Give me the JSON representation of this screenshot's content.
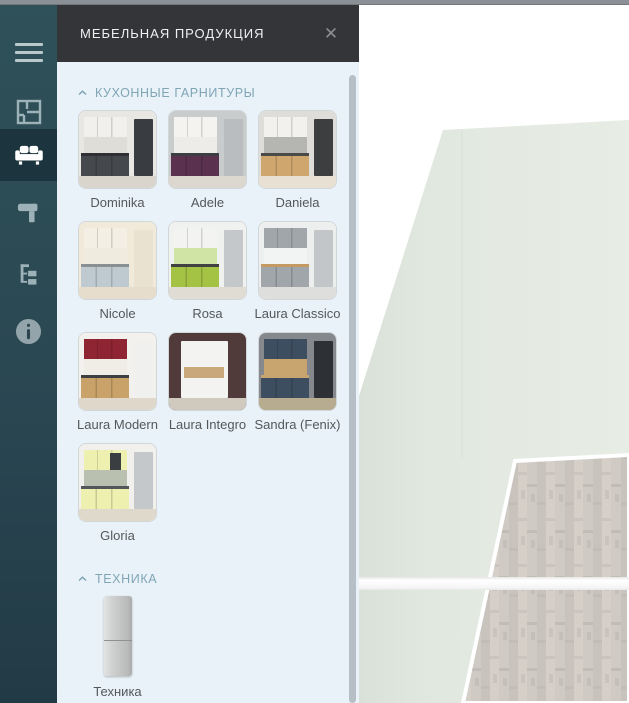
{
  "panel": {
    "title": "МЕБЕЛЬНАЯ ПРОДУКЦИЯ",
    "close_glyph": "✕",
    "sections": [
      {
        "title": "КУХОННЫЕ ГАРНИТУРЫ",
        "collapsed": false,
        "items": [
          {
            "label": "Dominika",
            "type": "corner",
            "palette": {
              "wall": "#e9e7e3",
              "splash": "#dfddd7",
              "upper": "#f1f0ed",
              "base": "#45484d",
              "counter": "#2e3033",
              "accent": "#393c41",
              "floor": "#d9d4cc"
            }
          },
          {
            "label": "Adele",
            "type": "corner",
            "palette": {
              "wall": "#c9cccd",
              "splash": "#eeece8",
              "upper": "#f4f3f0",
              "base": "#5b3150",
              "counter": "#3c3f41",
              "accent": "#b9bdbf",
              "floor": "#dcd7cf"
            }
          },
          {
            "label": "Daniela",
            "type": "corner",
            "palette": {
              "wall": "#deddda",
              "splash": "#b5b5b1",
              "upper": "#f2f1ee",
              "base": "#cfa76e",
              "counter": "#4a4a48",
              "accent": "#3c3e40",
              "floor": "#e7e0d3"
            }
          },
          {
            "label": "Nicole",
            "type": "corner",
            "palette": {
              "wall": "#f1e9da",
              "splash": "#f0ebdf",
              "upper": "#f4efe4",
              "base": "#bfcad0",
              "counter": "#8a8f92",
              "accent": "#e9e2d1",
              "floor": "#e6ddcc"
            }
          },
          {
            "label": "Rosa",
            "type": "corner",
            "palette": {
              "wall": "#f0f2f0",
              "splash": "#cfe4a5",
              "upper": "#f3f4f2",
              "base": "#a4c244",
              "counter": "#3f4143",
              "accent": "#c4c8cb",
              "floor": "#e0dbd3"
            }
          },
          {
            "label": "Laura Classico",
            "type": "corner",
            "palette": {
              "wall": "#edeeee",
              "splash": "#f2f3f3",
              "upper": "#a0a6aa",
              "base": "#a0a6aa",
              "counter": "#c49a62",
              "accent": "#c2c6c8",
              "floor": "#dededc"
            }
          },
          {
            "label": "Laura Modern",
            "type": "corner",
            "palette": {
              "wall": "#f3f1ed",
              "splash": "#f0ede7",
              "upper": "#8f2533",
              "base": "#c9a269",
              "counter": "#3e3f41",
              "accent": "#f0f0ee",
              "floor": "#ded7ca"
            }
          },
          {
            "label": "Laura Integro",
            "type": "integro",
            "palette": {
              "wall": "#503a3a",
              "block": "#f3f3f1",
              "wood": "#c9a87c",
              "floor": "#d0c9be"
            }
          },
          {
            "label": "Sandra (Fenix)",
            "type": "corner",
            "palette": {
              "wall": "#85898d",
              "splash": "#c8a56f",
              "upper": "#3e4e61",
              "base": "#3e4e61",
              "counter": "#c8a56f",
              "accent": "#2d3136",
              "floor": "#b7ab90"
            }
          },
          {
            "label": "Gloria",
            "type": "corner",
            "palette": {
              "wall": "#f1f0ec",
              "splash": "#b9c0af",
              "upper": "#edf0af",
              "base": "#edf0af",
              "counter": "#54575a",
              "accent": "#c5c8ca",
              "floor": "#dfd9cb",
              "hood": "#3b3e40"
            }
          }
        ]
      },
      {
        "title": "ТЕХНИКА",
        "collapsed": false,
        "items": [
          {
            "label": "Техника",
            "type": "fridge",
            "palette": {
              "body_light": "#e2e4e4",
              "body_dark": "#a9abab"
            }
          }
        ]
      }
    ]
  },
  "sidebar": {
    "items": [
      {
        "id": "menu",
        "icon": "hamburger",
        "active": false
      },
      {
        "id": "floor-plan",
        "icon": "floor-plan",
        "active": false
      },
      {
        "id": "furniture",
        "icon": "sofa",
        "active": true
      },
      {
        "id": "materials",
        "icon": "paint-roller",
        "active": false
      },
      {
        "id": "project-tree",
        "icon": "tree",
        "active": false
      },
      {
        "id": "info",
        "icon": "info",
        "active": false
      }
    ]
  },
  "scene": {
    "background": "#ffffff",
    "wall_color_left": "#d9e1d8",
    "wall_color_right": "#e7ece5",
    "floor_plank_colors": [
      "#d0cac4",
      "#c9c3be",
      "#d5cfc8"
    ],
    "floor_trim_color": "#ffffff",
    "band_color": "#fbfbfb"
  },
  "chrome": {
    "top_strip_color": "#8a9096",
    "sidebar_color": "#2f5159",
    "sidebar_active_color": "#1c343d",
    "header_color": "#333538",
    "panel_background": "#e9f2f8",
    "section_title_color": "#80a5b5",
    "label_color": "#54585b",
    "scrollbar_color": "#b6bfc5"
  }
}
